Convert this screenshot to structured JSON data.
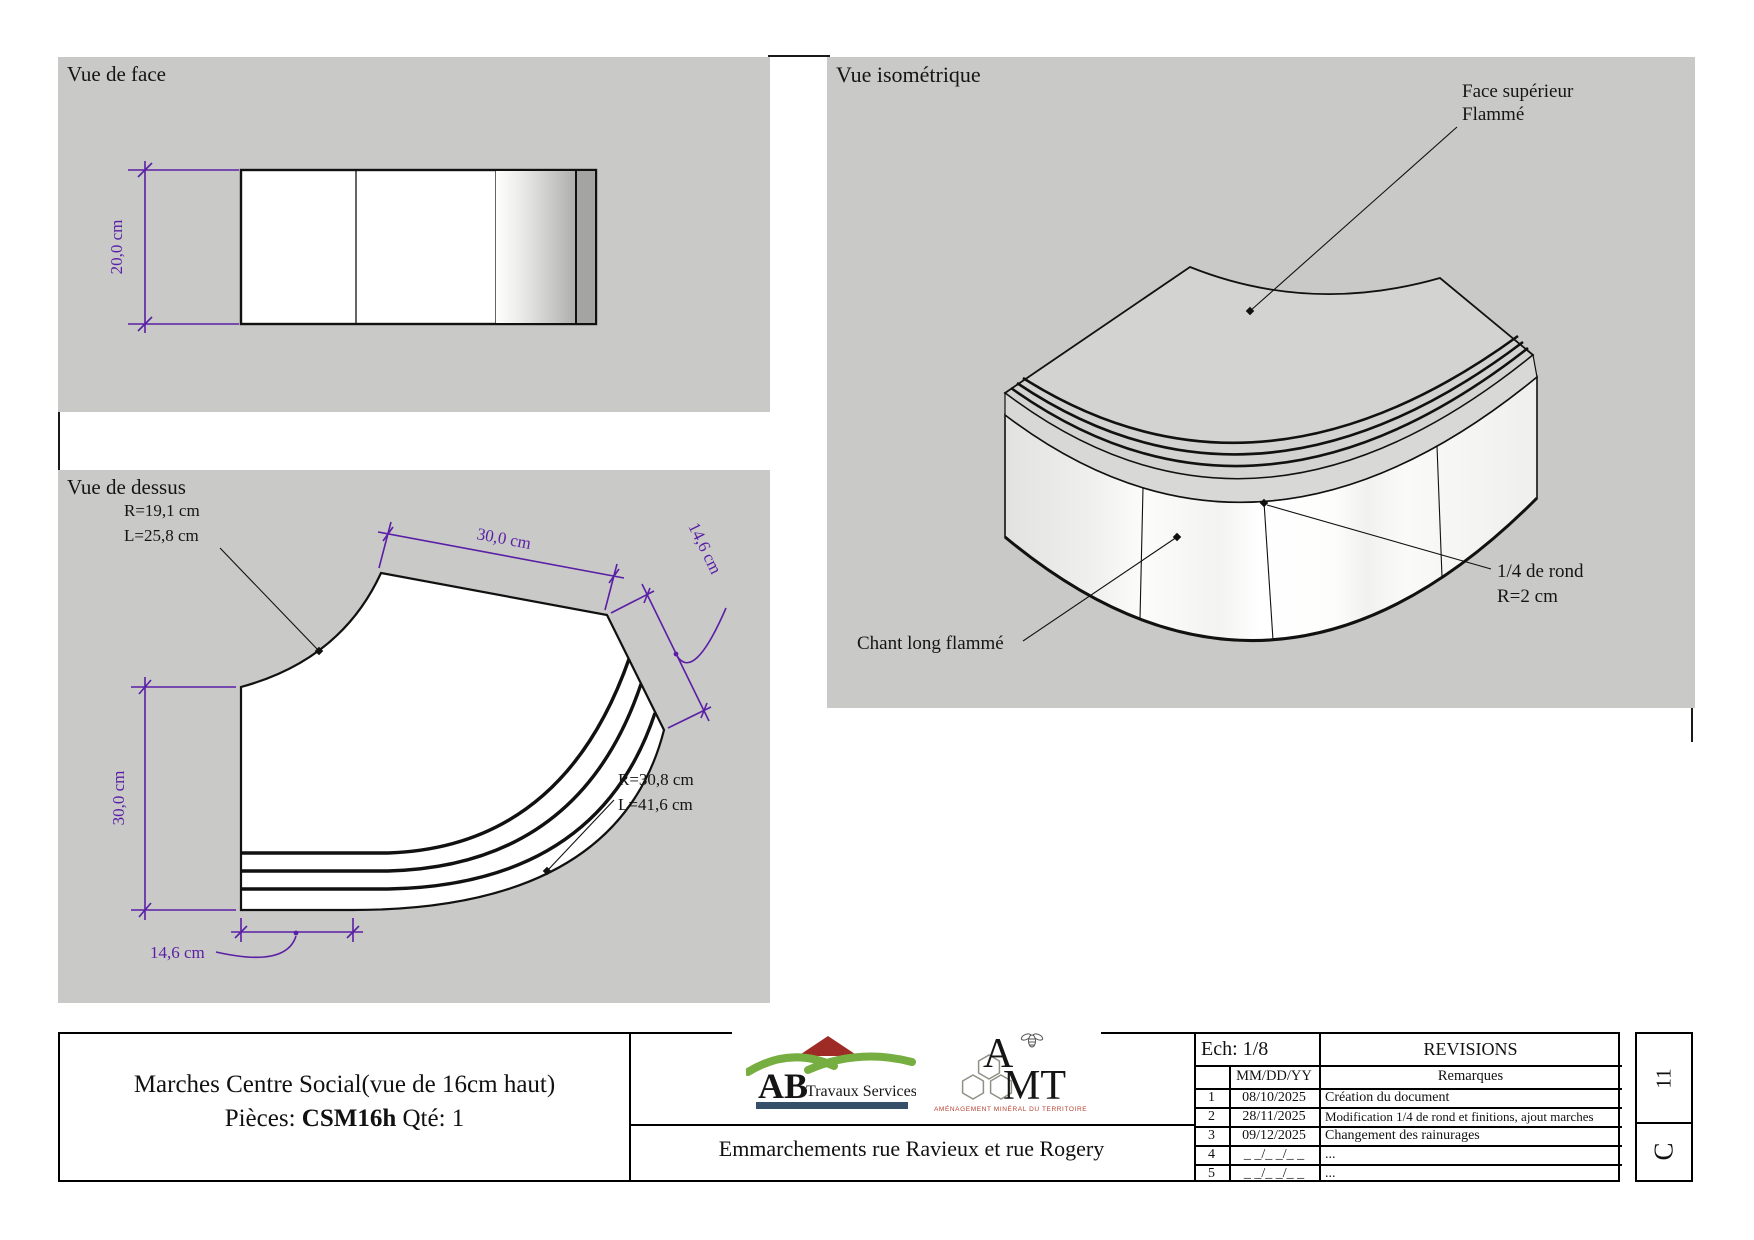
{
  "front_view": {
    "title": "Vue de face",
    "dim_height": "20,0 cm"
  },
  "top_view": {
    "title": "Vue de dessus",
    "dim_top": "30,0 cm",
    "dim_right": "14,6 cm",
    "dim_left": "30,0 cm",
    "dim_bottom": "14,6 cm",
    "r_inner_1": "R=19,1 cm",
    "r_inner_2": "L=25,8 cm",
    "r_outer_1": "R=30,8 cm",
    "r_outer_2": "L=41,6 cm"
  },
  "iso_view": {
    "title": "Vue isométrique",
    "face_label_1": "Face supérieur",
    "face_label_2": "Flammé",
    "nose_label_1": "1/4 de rond",
    "nose_label_2": "R=2 cm",
    "edge_label": "Chant long flammé"
  },
  "title_block": {
    "part_title": "Marches Centre Social(vue de 16cm haut)",
    "piece_prefix": "Pièces: ",
    "piece_code": "CSM16h",
    "piece_suffix": " Qté: 1",
    "project": "Emmarchements rue Ravieux et rue Rogery",
    "scale": "Ech: 1/8",
    "revisions_title": "REVISIONS",
    "date_header": "MM/DD/YY",
    "remarks_header": "Remarques",
    "revisions": [
      {
        "num": "1",
        "date": "08/10/2025",
        "remark": "Création du document"
      },
      {
        "num": "2",
        "date": "28/11/2025",
        "remark": "Modification 1/4 de rond et finitions, ajout marches"
      },
      {
        "num": "3",
        "date": "09/12/2025",
        "remark": "Changement des rainurages"
      },
      {
        "num": "4",
        "date": "_ _/_ _/_ _",
        "remark": "..."
      },
      {
        "num": "5",
        "date": "_ _/_ _/_ _",
        "remark": "..."
      }
    ],
    "sheet_number": "11",
    "sheet_letter": "C"
  },
  "logos": {
    "ab": {
      "name_bold": "AB",
      "name_rest": "Travaux Services"
    },
    "amt": {
      "a": "A",
      "mt": "MT",
      "tagline": "AMÉNAGEMENT MINÉRAL DU TERRITOIRE"
    }
  },
  "colors": {
    "panel_gray": "#c9c9c7",
    "dimension_purple": "#5a1fa6",
    "line_black": "#1a1a1a",
    "ab_green": "#76ae41",
    "ab_red": "#9e2b25",
    "ab_slate": "#36506a",
    "amt_red": "#9c3a22"
  }
}
